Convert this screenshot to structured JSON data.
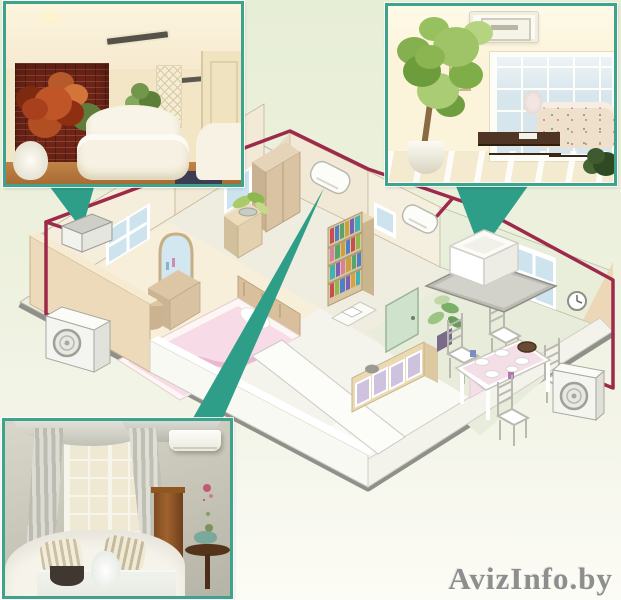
{
  "colors": {
    "accent_teal": "#2f9e88",
    "photo_border": "#3fa28d",
    "pipe_maroon": "#9d2a4b",
    "bg_top": "#e7eed6",
    "bg_mid": "#edf1de",
    "bg_bottom": "#fcfcf6",
    "watermark_gray": "#8e8e8e"
  },
  "watermark": {
    "text": "AvizInfo.by"
  },
  "insets": [
    {
      "id": "inset-top-left",
      "alt": "living room photo with brick wall and ceiling air vents"
    },
    {
      "id": "inset-top-right",
      "alt": "sunroom photo with ceiling cassette air conditioner"
    },
    {
      "id": "inset-bottom-left",
      "alt": "living room photo with wall mounted split air conditioner"
    }
  ],
  "scene": {
    "alt": "isometric apartment cutaway showing multi-split air conditioning system",
    "indoor_units": [
      {
        "id": "bedroom-wall-unit",
        "label": "wall-mounted indoor unit (bedroom)"
      },
      {
        "id": "hall-wall-unit",
        "label": "wall-mounted indoor unit (hall)"
      },
      {
        "id": "study-wall-unit",
        "label": "wall-mounted indoor unit (study)"
      },
      {
        "id": "dining-cassette-unit",
        "label": "ceiling cassette indoor unit (dining room)"
      }
    ],
    "outdoor_units": [
      {
        "id": "outdoor-unit-left",
        "label": "outdoor condenser unit (left)"
      },
      {
        "id": "outdoor-unit-right",
        "label": "outdoor condenser unit (right)"
      }
    ],
    "piping_label": "refrigerant piping run",
    "callouts": [
      "callout from top-left photo to bedroom unit",
      "callout from bottom-left photo to hall unit",
      "callout from top-right photo to dining cassette"
    ]
  }
}
